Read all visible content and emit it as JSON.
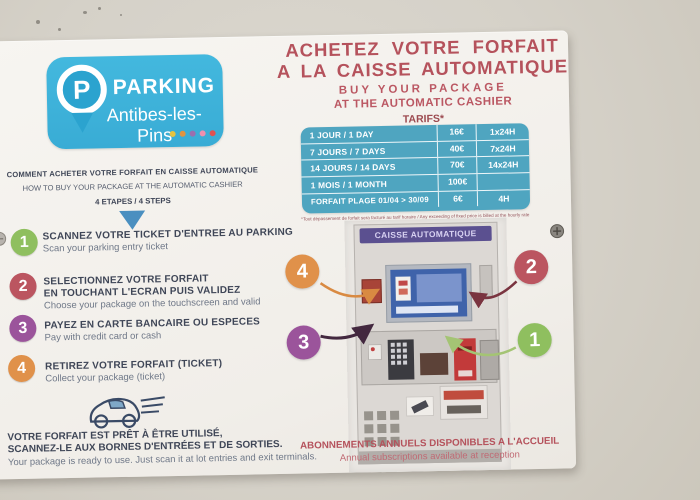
{
  "sign": {
    "logo": {
      "pin_letter": "P",
      "brand": "PARKING",
      "location": "Antibes-les-Pins",
      "brand_color": "#3db2da",
      "dot_colors": [
        "#e7c33f",
        "#e09440",
        "#9a6fae",
        "#ef8fae",
        "#e05252"
      ]
    },
    "intro": {
      "fr": "COMMENT ACHETER VOTRE FORFAIT EN CAISSE AUTOMATIQUE",
      "en": "HOW TO BUY YOUR PACKAGE AT THE AUTOMATIC CASHIER",
      "steps": "4 ETAPES / 4 STEPS"
    },
    "steps": [
      {
        "num": "1",
        "color": "#8fbf5f",
        "title1": "SCANNEZ VOTRE TICKET D'ENTREE AU PARKING",
        "title2": "",
        "sub": "Scan your parking entry ticket"
      },
      {
        "num": "2",
        "color": "#bb5560",
        "title1": "SELECTIONNEZ VOTRE FORFAIT",
        "title2": "EN TOUCHANT L'ECRAN PUIS VALIDEZ",
        "sub": "Choose your package on the touchscreen and valid"
      },
      {
        "num": "3",
        "color": "#9b549b",
        "title1": "PAYEZ EN CARTE BANCAIRE OU ESPECES",
        "title2": "",
        "sub": "Pay with credit card or cash"
      },
      {
        "num": "4",
        "color": "#e0914a",
        "title1": "RETIREZ VOTRE FORFAIT (TICKET)",
        "title2": "",
        "sub": "Collect your package (ticket)"
      }
    ],
    "ready": {
      "fr1": "VOTRE FORFAIT EST PRÊT À ÊTRE UTILISÉ,",
      "fr2": "SCANNEZ-LE AUX BORNES D'ENTRÉES ET DE SORTIES.",
      "en": "Your package is ready to use. Just scan it at lot entries and exit terminals."
    },
    "offer": {
      "title_fr1": "ACHETEZ VOTRE FORFAIT",
      "title_fr2": "A LA CAISSE AUTOMATIQUE",
      "title_en1": "BUY YOUR PACKAGE",
      "title_en2": "AT THE AUTOMATIC CASHIER",
      "tarifs": "TARIFS*",
      "accent_color": "#b5525c",
      "table_color": "#4fa5c0",
      "table_rows": [
        {
          "label": "1 JOUR / 1 DAY",
          "price": "16€",
          "duration": "1x24H"
        },
        {
          "label": "7 JOURS / 7 DAYS",
          "price": "40€",
          "duration": "7x24H"
        },
        {
          "label": "14 JOURS / 14 DAYS",
          "price": "70€",
          "duration": "14x24H"
        },
        {
          "label": "1 MOIS / 1 MONTH",
          "price": "100€",
          "duration": ""
        },
        {
          "label": "FORFAIT PLAGE  01/04 > 30/09",
          "price": "6€",
          "duration": "4H"
        }
      ],
      "footnote": "*Tout dépassement de forfait sera facturé au tarif horaire / Any exceeding of fixed price is billed at the hourly rate"
    },
    "machine": {
      "title": "CAISSE AUTOMATIQUE",
      "header_color": "#5b5090"
    },
    "callouts": [
      {
        "num": "4",
        "color": "#e0914a"
      },
      {
        "num": "2",
        "color": "#bb5560"
      },
      {
        "num": "3",
        "color": "#9b549b"
      },
      {
        "num": "1",
        "color": "#8fbf5f"
      }
    ],
    "annual": {
      "fr": "ABONNEMENTS ANNUELS DISPONIBLES A L'ACCUEIL",
      "en": "Annual subscriptions available at reception"
    }
  }
}
